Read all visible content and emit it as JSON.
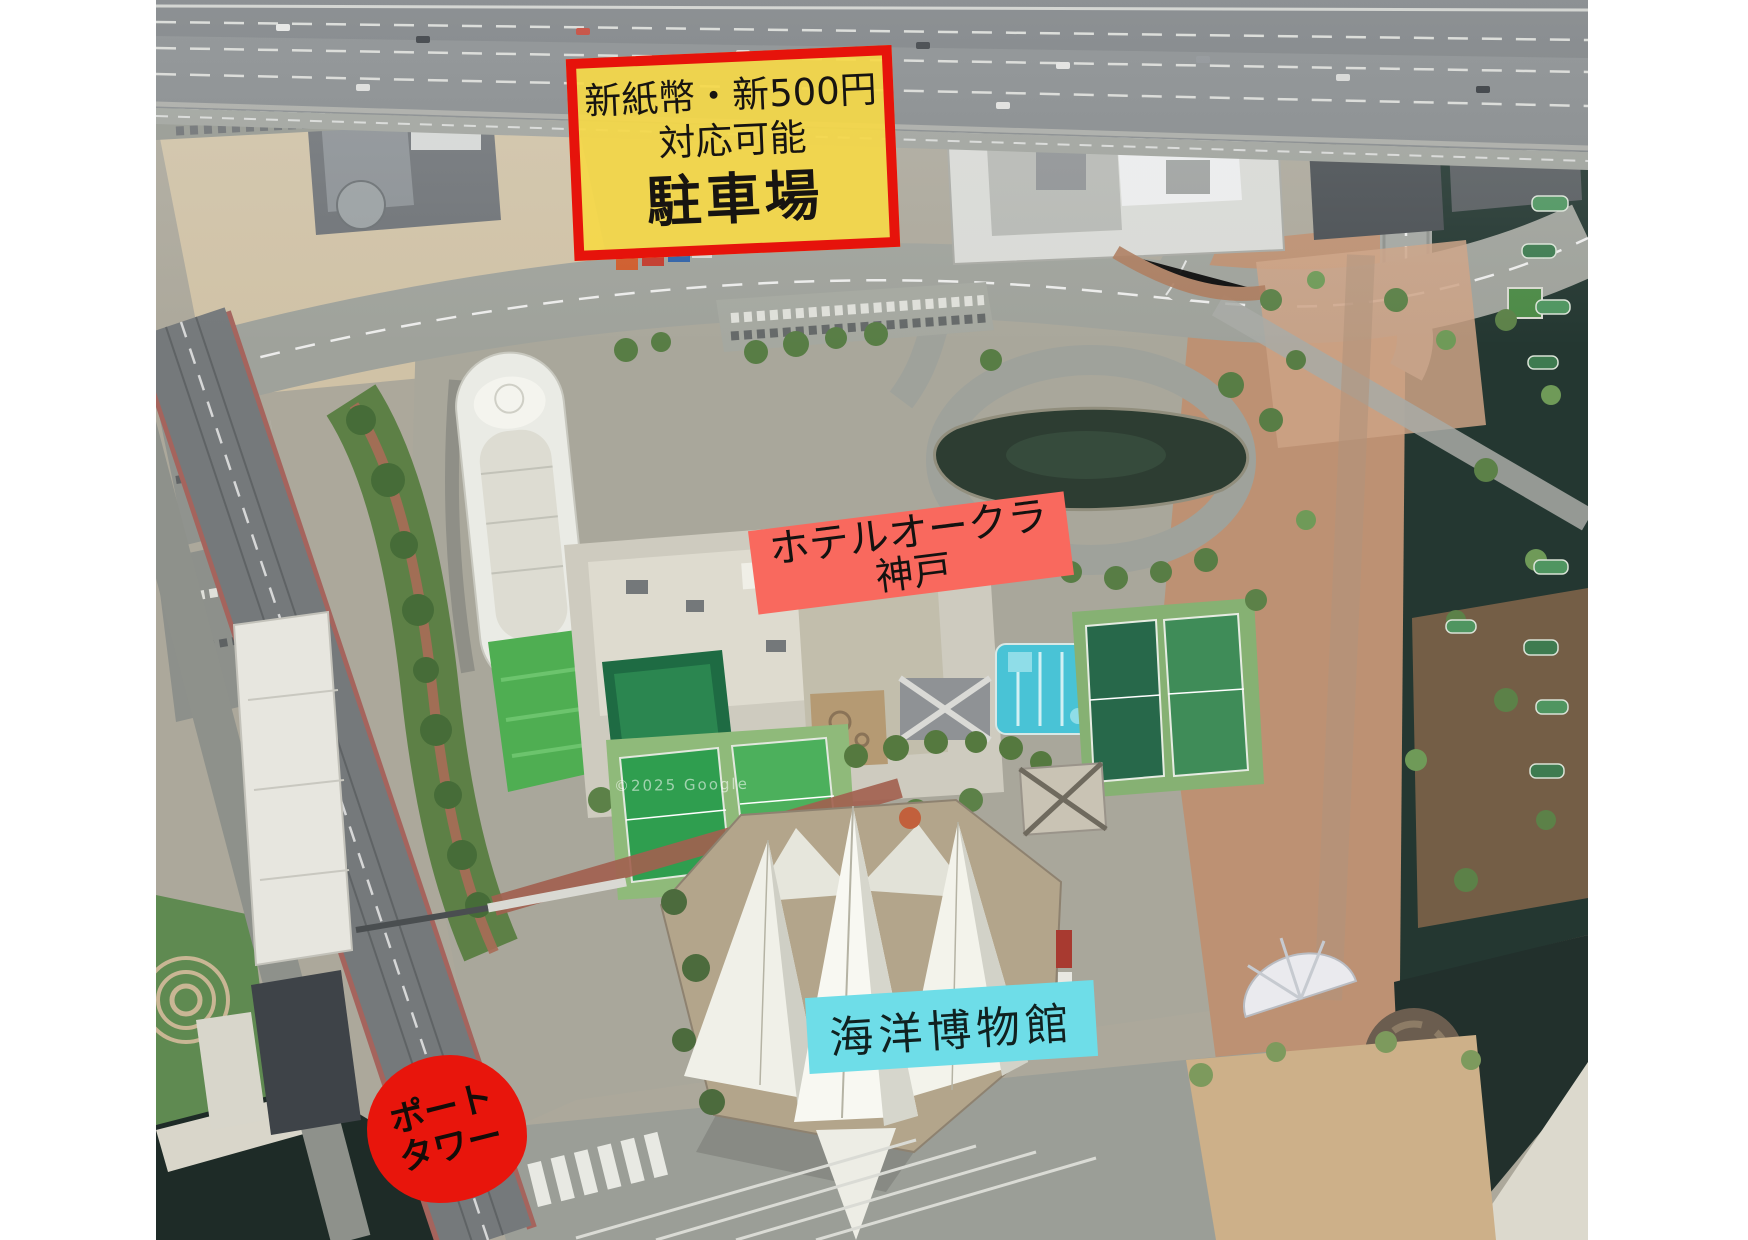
{
  "map": {
    "provider_watermark": "©2025 Google"
  },
  "annotations": {
    "parking_sign": {
      "lines": [
        "新紙幣・新500円",
        "対応可能",
        "駐車場"
      ],
      "bg": "rgba(245,216,72,0.92)",
      "border": "#e6130b",
      "text": "#171411"
    },
    "hotel_okura": {
      "lines": [
        "ホテルオークラ",
        "神戸"
      ],
      "bg": "#f9695e",
      "text": "#141210"
    },
    "maritime_museum": {
      "label": "海洋博物館",
      "bg": "#6edde8",
      "text": "#102120"
    },
    "port_tower": {
      "lines": [
        "ポート",
        "タワー"
      ],
      "bg": "#e8150c",
      "text": "#140c08"
    }
  }
}
